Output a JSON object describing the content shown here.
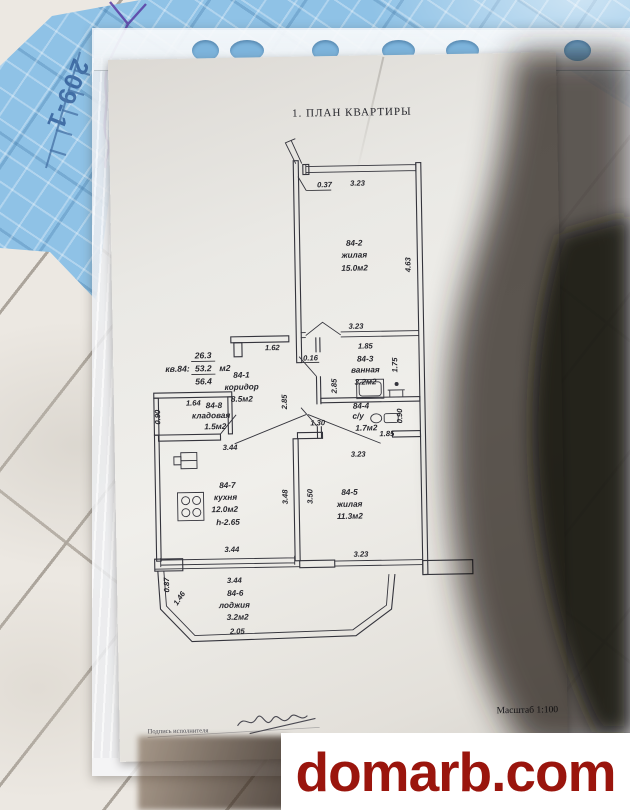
{
  "photo": {
    "mat_marking": "209-1",
    "watermark": "domarb.com"
  },
  "document": {
    "title": "1. ПЛАН КВАРТИРЫ",
    "scale_label": "Масштаб 1:100",
    "signature_label": "Подпись исполнителя",
    "apartment": {
      "label": "кв.84:",
      "living_area": "26.3",
      "total_area": "53.2",
      "area_unit": "м2",
      "total_with_balcony": "56.4"
    },
    "rooms": [
      {
        "id": "84-1",
        "name": "коридор",
        "area": "8.5м2"
      },
      {
        "id": "84-2",
        "name": "жилая",
        "area": "15.0м2"
      },
      {
        "id": "84-3",
        "name": "ванная",
        "area": "3.2м2"
      },
      {
        "id": "84-4",
        "name": "с/у",
        "area": "1.7м2"
      },
      {
        "id": "84-5",
        "name": "жилая",
        "area": "11.3м2"
      },
      {
        "id": "84-6",
        "name": "лоджия",
        "area": "3.2м2"
      },
      {
        "id": "84-7",
        "name": "кухня",
        "area": "12.0м2",
        "height": "h-2.65"
      },
      {
        "id": "84-8",
        "name": "кладовая",
        "area": "1.5м2"
      }
    ],
    "dimensions": {
      "entry_opening": "0.37",
      "room2_window": "3.23",
      "room2_height": "4.63",
      "hall_wall": "1.62",
      "mid_width": "3.23",
      "bath_width": "1.85",
      "partition": "0.16",
      "bath_depth": "1.75",
      "wall_a": "2.85",
      "wall_b": "2.85",
      "wc_width": "1.30",
      "wc_shaft": "0.90",
      "wc_bottom": "1.85",
      "living_top": "3.23",
      "storage_width": "1.64",
      "storage_depth": "0.90",
      "kitchen_top": "3.44",
      "kitchen_height": "3.48",
      "living_height": "3.50",
      "living_bottom": "3.23",
      "kitchen_bottom": "3.44",
      "balcony_top": "3.44",
      "balcony_bottom": "2.05",
      "balcony_diag": "1.46",
      "balcony_left": "0.87"
    }
  }
}
